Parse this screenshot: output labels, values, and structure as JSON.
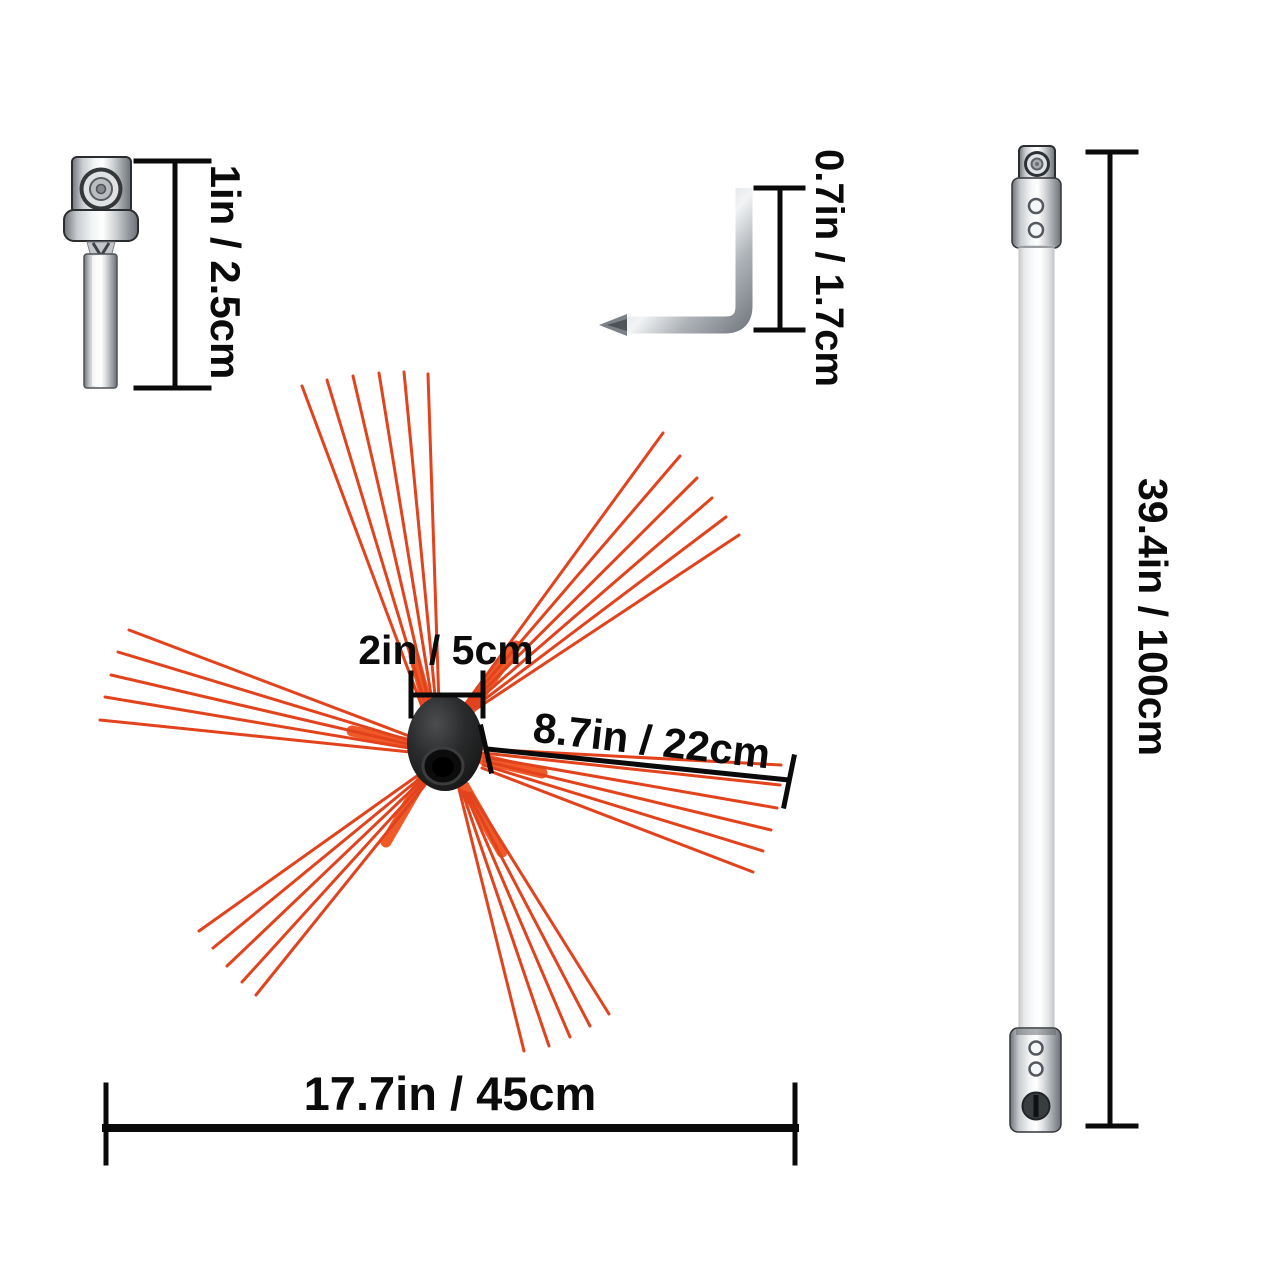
{
  "diagram_title": "Chimney brush kit dimension diagram",
  "background": "#ffffff",
  "colors": {
    "bristle": "#e2431d",
    "bristle_base": "#ef5a28",
    "hub": "#1a1a1a",
    "dimension_line": "#0a0a0a",
    "label_text": "#0b0b0b",
    "metal_light": "#f2f4f5",
    "metal_dark": "#6f7479"
  },
  "parts": {
    "drill_adapter": {
      "height_label": "1in / 2.5cm"
    },
    "hex_key": {
      "length_label": "0.7in / 1.7cm"
    },
    "brush_head": {
      "hub_width_label": "2in / 5cm",
      "bristle_length_label": "8.7in / 22cm",
      "overall_width_label": "17.7in / 45cm"
    },
    "extension_rod": {
      "length_label": "39.4in / 100cm"
    }
  }
}
